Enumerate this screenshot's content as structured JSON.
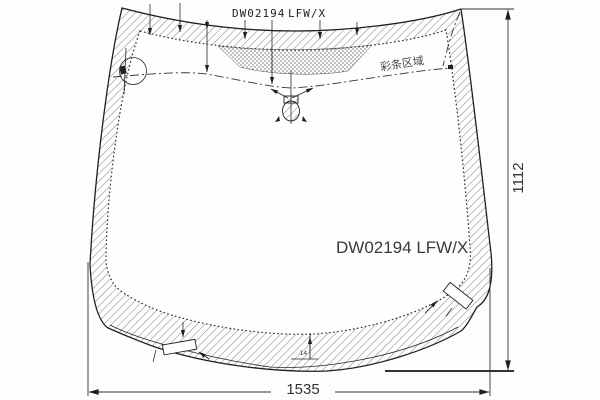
{
  "drawing": {
    "part_code": "DW02194",
    "part_variant": "LFW/X",
    "center_label": "DW02194 LFW/X",
    "shade_band_label": "彩条区域",
    "dimensions": {
      "width": "1535",
      "height": "1112",
      "band_width": "14"
    },
    "line_color": "#1f1f1f",
    "background": "#fefefe"
  }
}
